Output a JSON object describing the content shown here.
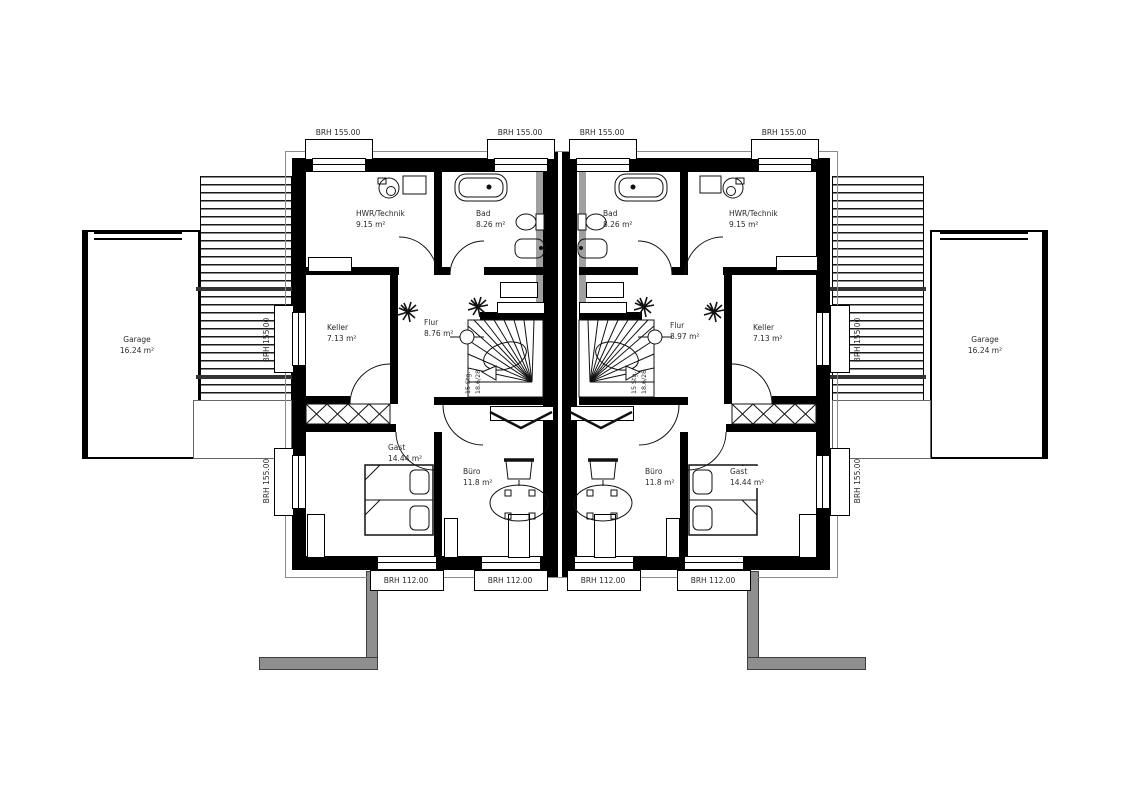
{
  "plan": {
    "stair_note": {
      "line1": "15 Stg.",
      "line2": "18.6/28"
    },
    "brh_top": [
      "BRH 155.00",
      "BRH 155.00",
      "BRH 155.00",
      "BRH 155.00"
    ],
    "brh_bottom": [
      "BRH 112.00",
      "BRH 112.00",
      "BRH 112.00",
      "BRH 112.00"
    ],
    "brh_left": [
      "BRH 155.00",
      "BRH 155.00"
    ],
    "brh_right": [
      "BRH 155.00",
      "BRH 155.00"
    ],
    "garage_left": {
      "name": "Garage",
      "area": "16.24 m²"
    },
    "garage_right": {
      "name": "Garage",
      "area": "16.24 m²"
    },
    "unit_left": {
      "hwr": {
        "name": "HWR/Technik",
        "area": "9.15 m²"
      },
      "bad": {
        "name": "Bad",
        "area": "8.26 m²"
      },
      "keller": {
        "name": "Keller",
        "area": "7.13 m²"
      },
      "flur": {
        "name": "Flur",
        "area": "8.76 m²"
      },
      "gast": {
        "name": "Gast",
        "area": "14.44 m²"
      },
      "buero": {
        "name": "Büro",
        "area": "11.8 m²"
      }
    },
    "unit_right": {
      "hwr": {
        "name": "HWR/Technik",
        "area": "9.15 m²"
      },
      "bad": {
        "name": "Bad",
        "area": "8.26 m²"
      },
      "keller": {
        "name": "Keller",
        "area": "7.13 m²"
      },
      "flur": {
        "name": "Flur",
        "area": "8.97 m²"
      },
      "gast": {
        "name": "Gast",
        "area": "14.44 m²"
      },
      "buero": {
        "name": "Büro",
        "area": "11.8 m²"
      }
    },
    "colors": {
      "wall": "#000000",
      "insulation": "#a0a0a0",
      "path": "#8f8f8f"
    }
  }
}
